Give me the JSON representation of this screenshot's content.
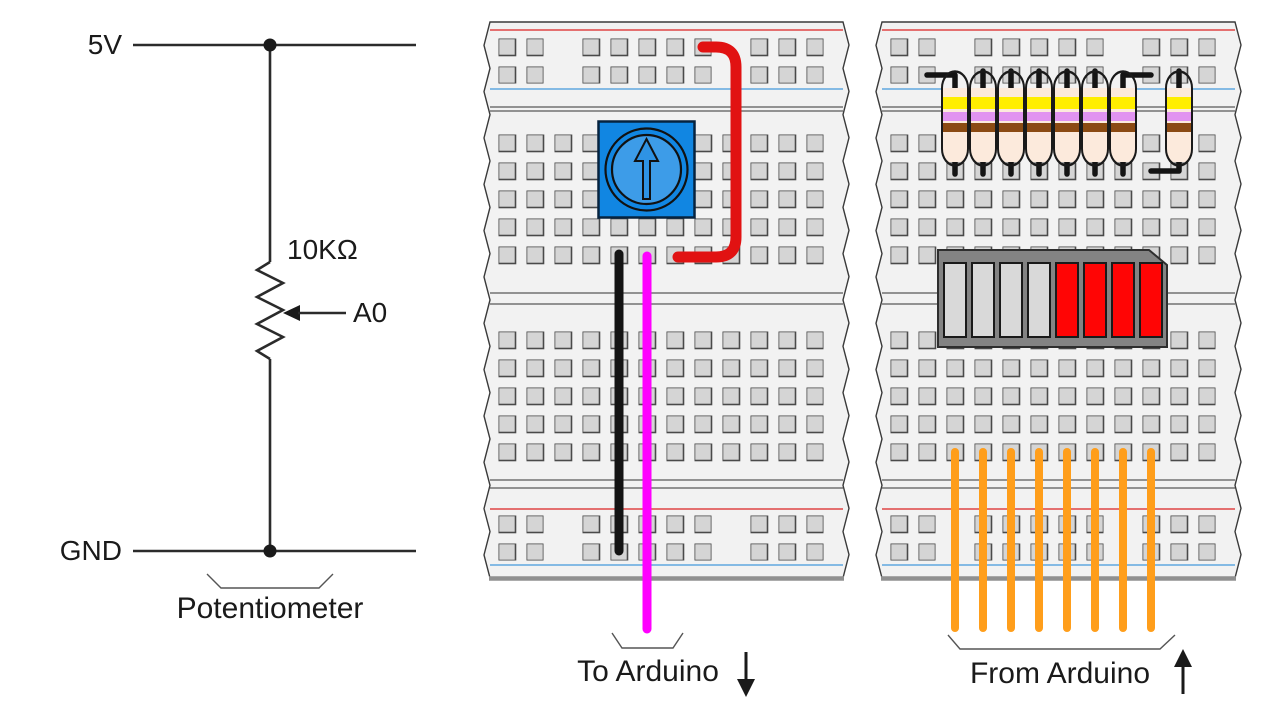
{
  "schematic": {
    "power_label": "5V",
    "ground_label": "GND",
    "resistor_value": "10KΩ",
    "tap_label": "A0",
    "caption": "Potentiometer"
  },
  "pot_board": {
    "caption": "To Arduino",
    "arrow_icon": "arrow-down",
    "component": "rotary potentiometer",
    "wires": [
      {
        "name": "5v-jumper-wire",
        "color": "#e11212"
      },
      {
        "name": "ground-wire",
        "color": "#141414"
      },
      {
        "name": "signal-wire-to-a0",
        "color": "#ff00ff"
      }
    ]
  },
  "bar_board": {
    "caption": "From Arduino",
    "arrow_icon": "arrow-up",
    "resistor_count": 8,
    "resistor_band_colors": [
      "yellow",
      "violet",
      "brown"
    ],
    "bargraph": {
      "segment_count": 8,
      "segments_off": 4,
      "segments_on": 4,
      "on_color": "#ff0505",
      "off_color": "#d9d9d9"
    },
    "wire_count": 8,
    "wire_color": "#ff9e1b"
  },
  "board_colors": {
    "body": "#f2f2f2",
    "hole": "#d5d5d5",
    "rail_red_line": "#e04545",
    "rail_blue_line": "#5fa8e0",
    "potentiometer_blue": "#1186e2",
    "bargraph_gray": "#838383"
  }
}
